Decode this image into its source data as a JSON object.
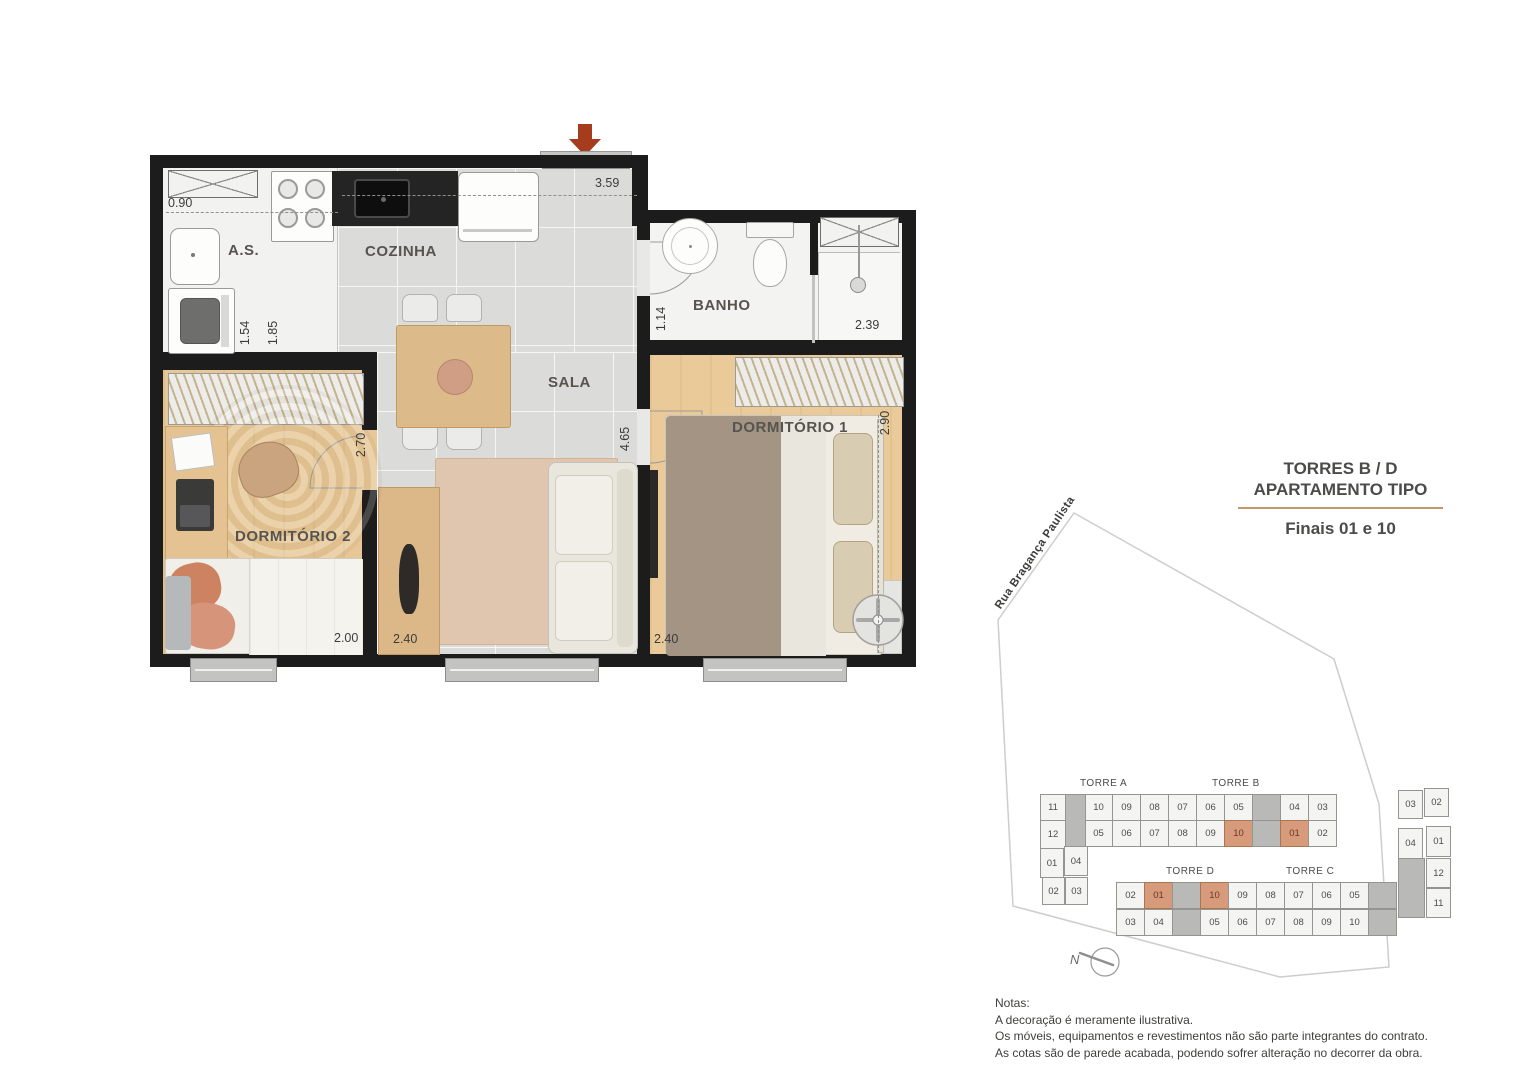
{
  "title": {
    "line1": "TORRES B / D",
    "line2": "APARTAMENTO TIPO",
    "subtitle": "Finais 01 e 10"
  },
  "floor_plan": {
    "rooms": {
      "as": "A.S.",
      "cozinha": "COZINHA",
      "sala": "SALA",
      "banho": "BANHO",
      "dorm1": "DORMITÓRIO 1",
      "dorm2": "DORMITÓRIO 2"
    },
    "dimensions": {
      "top_width": "3.59",
      "as_width": "0.90",
      "as_depth": "1.54",
      "kitchen_depth": "1.85",
      "banho_depth": "1.14",
      "banho_width": "2.39",
      "dorm1_depth": "2.90",
      "dorm1_width": "2.40",
      "dorm2_depth": "2.70",
      "dorm2_width": "2.00",
      "sala_width": "2.40",
      "sala_depth": "4.65"
    }
  },
  "site_plan": {
    "street": "Rua Bragança Paulista",
    "north": "N",
    "highlight_color": "#d79a7a",
    "towers": {
      "a": "TORRE A",
      "b": "TORRE B",
      "c": "TORRE C",
      "d": "TORRE D"
    },
    "building_ab": {
      "top_row": [
        {
          "n": "10"
        },
        {
          "n": "09"
        },
        {
          "n": "08"
        },
        {
          "n": "07"
        },
        {
          "n": "06"
        },
        {
          "n": "05"
        },
        {
          "core": true
        },
        {
          "n": "04"
        },
        {
          "n": "03"
        }
      ],
      "bottom_row": [
        {
          "n": "05"
        },
        {
          "n": "06"
        },
        {
          "n": "07"
        },
        {
          "n": "08"
        },
        {
          "n": "09"
        },
        {
          "n": "10",
          "hl": true
        },
        {
          "core": true
        },
        {
          "n": "01",
          "hl": true
        },
        {
          "n": "02"
        }
      ],
      "left_wing": [
        {
          "n": "11"
        },
        {
          "n": "12"
        },
        {
          "n": "01"
        },
        {
          "n": "04"
        },
        {
          "n": "02"
        },
        {
          "n": "03"
        }
      ]
    },
    "building_dc": {
      "top_row": [
        {
          "n": "02"
        },
        {
          "n": "01",
          "hl": true
        },
        {
          "core": true
        },
        {
          "n": "10",
          "hl": true
        },
        {
          "n": "09"
        },
        {
          "n": "08"
        },
        {
          "n": "07"
        },
        {
          "n": "06"
        },
        {
          "n": "05"
        },
        {
          "core": true
        }
      ],
      "bottom_row": [
        {
          "n": "03"
        },
        {
          "n": "04"
        },
        {
          "core": true
        },
        {
          "n": "05"
        },
        {
          "n": "06"
        },
        {
          "n": "07"
        },
        {
          "n": "08"
        },
        {
          "n": "09"
        },
        {
          "n": "10"
        },
        {
          "core": true
        }
      ],
      "right_wing": [
        {
          "n": "03"
        },
        {
          "n": "02"
        },
        {
          "n": "04"
        },
        {
          "n": "01"
        },
        {
          "n": "12"
        },
        {
          "n": "11"
        }
      ]
    }
  },
  "notes": {
    "heading": "Notas:",
    "lines": [
      "A decoração é meramente ilustrativa.",
      "Os móveis, equipamentos e revestimentos não são parte integrantes do contrato.",
      "As cotas são de parede acabada, podendo sofrer alteração no decorrer da obra."
    ]
  }
}
